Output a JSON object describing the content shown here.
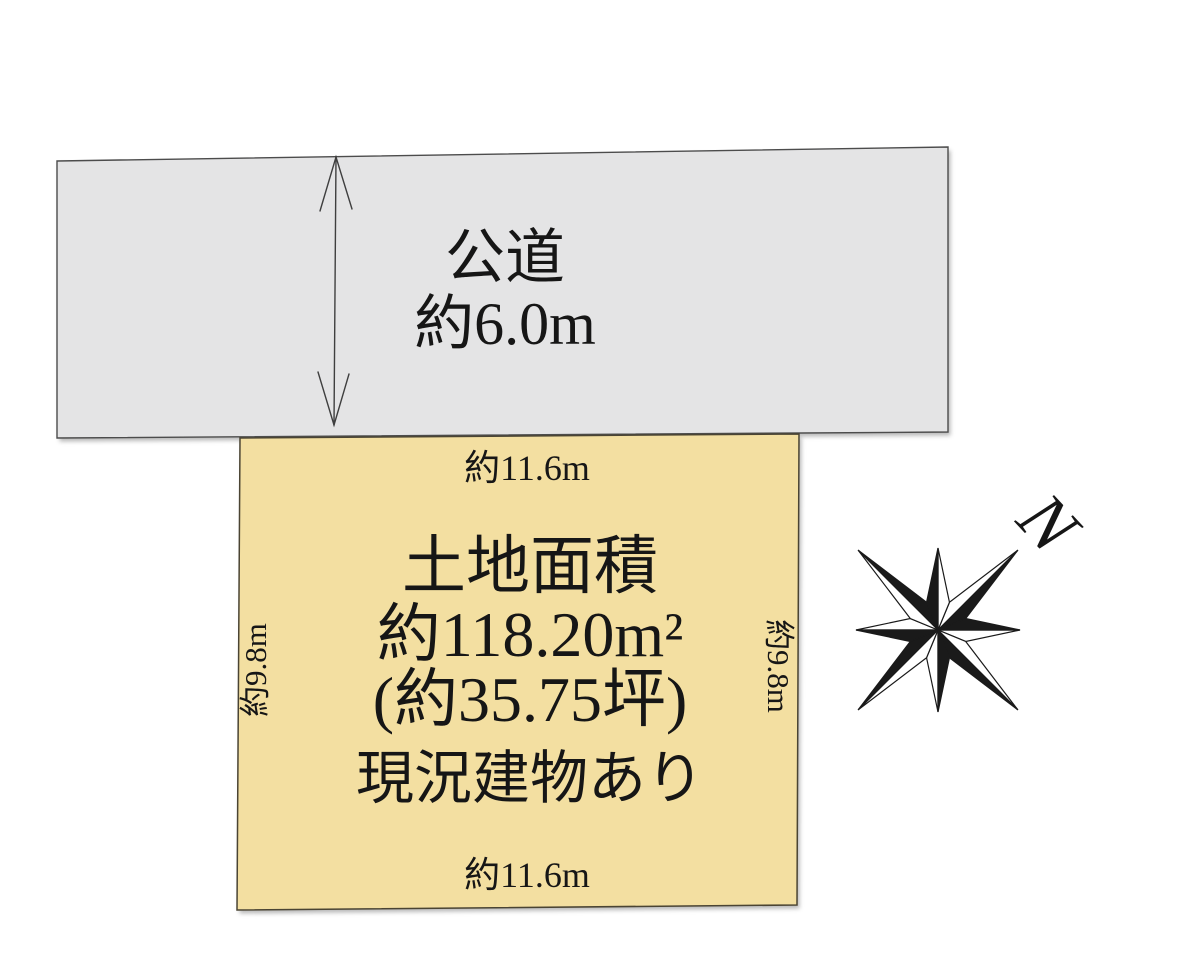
{
  "colors": {
    "background": "#ffffff",
    "road_fill": "#e4e4e5",
    "road_stroke": "#4c4c4c",
    "plot_fill": "#f3dfa1",
    "plot_stroke": "#4a4433",
    "arrow_stroke": "#3f3f3f",
    "ink": "#161616",
    "compass_dark": "#1a1a1a"
  },
  "road": {
    "name": "公道",
    "width_label": "約6.0m"
  },
  "plot": {
    "top_dim": "約11.6m",
    "bottom_dim": "約11.6m",
    "left_dim": "約9.8m",
    "right_dim": "約9.8m",
    "title": "土地面積",
    "area_m2": "約118.20m²",
    "area_tsubo": "(約35.75坪)",
    "status": "現況建物あり"
  },
  "compass": {
    "north_label": "N"
  }
}
